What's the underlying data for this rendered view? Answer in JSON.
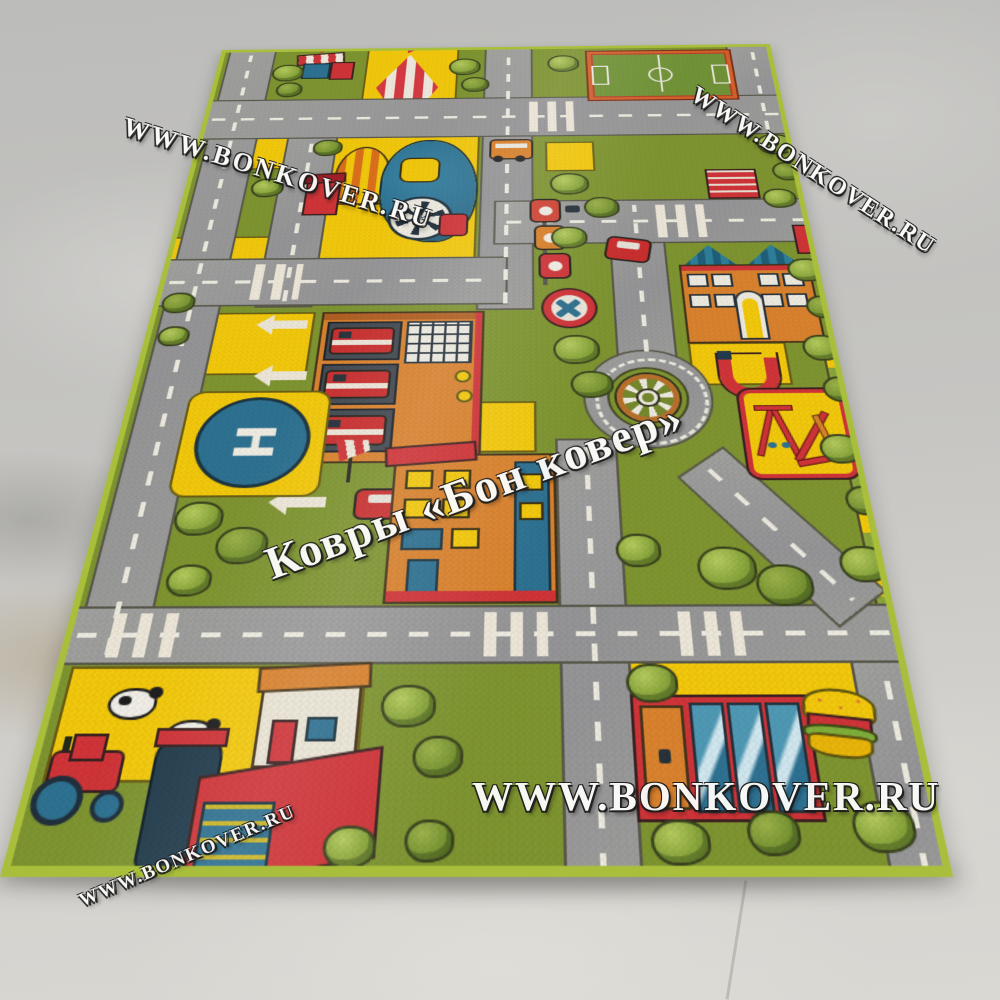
{
  "watermarks": {
    "site_url": "WWW.BONKOVER.RU",
    "brand_name": "Ковры «Бон ковер»"
  },
  "rug": {
    "helipad_letter": "H",
    "landmarks": [
      "circus-tent",
      "carousel-kiosk",
      "locomotive-ride",
      "football-field",
      "fire-station",
      "fire-trucks",
      "helipad",
      "windsock",
      "traffic-lights",
      "no-entry-sign",
      "roundabout-wheel",
      "school-building",
      "magnet-arch",
      "playground",
      "red-bench",
      "farm-field",
      "cows",
      "tractor",
      "farmhouse",
      "barn-silo",
      "market-building",
      "burger-stand",
      "trees",
      "roads-with-dashes",
      "crosswalks"
    ]
  },
  "palette": {
    "grass_green": "#7e9430",
    "road_gray": "#9a9a98",
    "accent_yellow": "#f2c80c",
    "rug_edge_lime": "#a9bf3b",
    "signal_red": "#cf3438",
    "building_orange": "#d9822e",
    "water_teal": "#2e7191",
    "floor_gray": "#c6c5c2"
  }
}
